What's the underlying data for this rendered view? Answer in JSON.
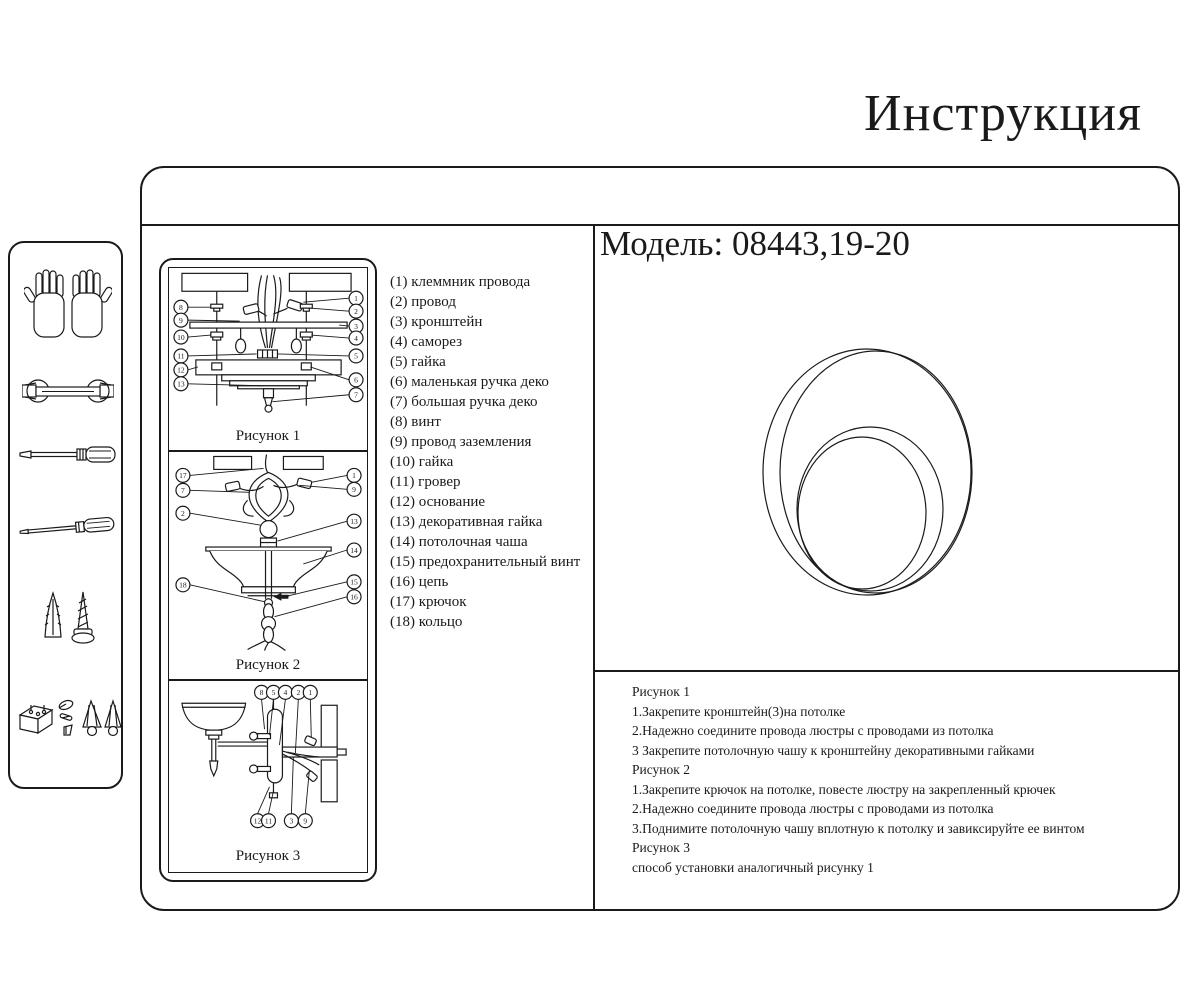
{
  "title": "Инструкция",
  "model_line": "Модель: 08443,19-20",
  "colors": {
    "ink": "#1a1a1a",
    "paper": "#ffffff"
  },
  "parts": [
    "(1) клеммник провода",
    "(2) провод",
    "(3) кронштейн",
    "(4) саморез",
    "(5) гайка",
    "(6) маленькая ручка деко",
    "(7) большая ручка деко",
    "(8) винт",
    "(9) провод заземления",
    "(10) гайка",
    "(11) гровер",
    "(12) основание",
    "(13) декоративная гайка",
    "(14) потолочная чаша",
    "(15) предохранительный винт",
    "(16) цепь",
    "(17) крючок",
    "(18) кольцо"
  ],
  "figures": {
    "fig1": {
      "label": "Рисунок 1",
      "left": [
        "8",
        "9",
        "10",
        "11",
        "12",
        "13"
      ],
      "right": [
        "1",
        "2",
        "3",
        "4",
        "5",
        "6",
        "7"
      ]
    },
    "fig2": {
      "label": "Рисунок 2",
      "left": [
        "17",
        "7",
        "2",
        "18"
      ],
      "right": [
        "1",
        "9",
        "13",
        "14",
        "15",
        "16"
      ]
    },
    "fig3": {
      "label": "Рисунок 3",
      "top": [
        "8",
        "5",
        "4",
        "2",
        "1"
      ],
      "bottom": [
        "12",
        "11",
        "3",
        "9"
      ]
    }
  },
  "instructions": [
    "Рисунок 1",
    "1.Закрепите кронштейн(3)на потолке",
    "2.Надежно соедините провода люстры с проводами из потолка",
    "3 Закрепите потолочную чашу к кронштейну декоративными гайками",
    "Рисунок 2",
    "1.Закрепите крючок на потолке, повесте люстру на закрепленный крючек",
    "2.Надежно соедините провода люстры с проводами из потолка",
    "3.Поднимите потолочную чашу вплотную к потолку и завиксируйте ее винтом",
    "Рисунок 3",
    "способ установки аналогичный рисунку 1"
  ],
  "sidebar_icons": [
    "gloves",
    "wrench",
    "screwdriver",
    "thin-screwdriver",
    "wall-anchor-and-screw",
    "hardware-set"
  ]
}
